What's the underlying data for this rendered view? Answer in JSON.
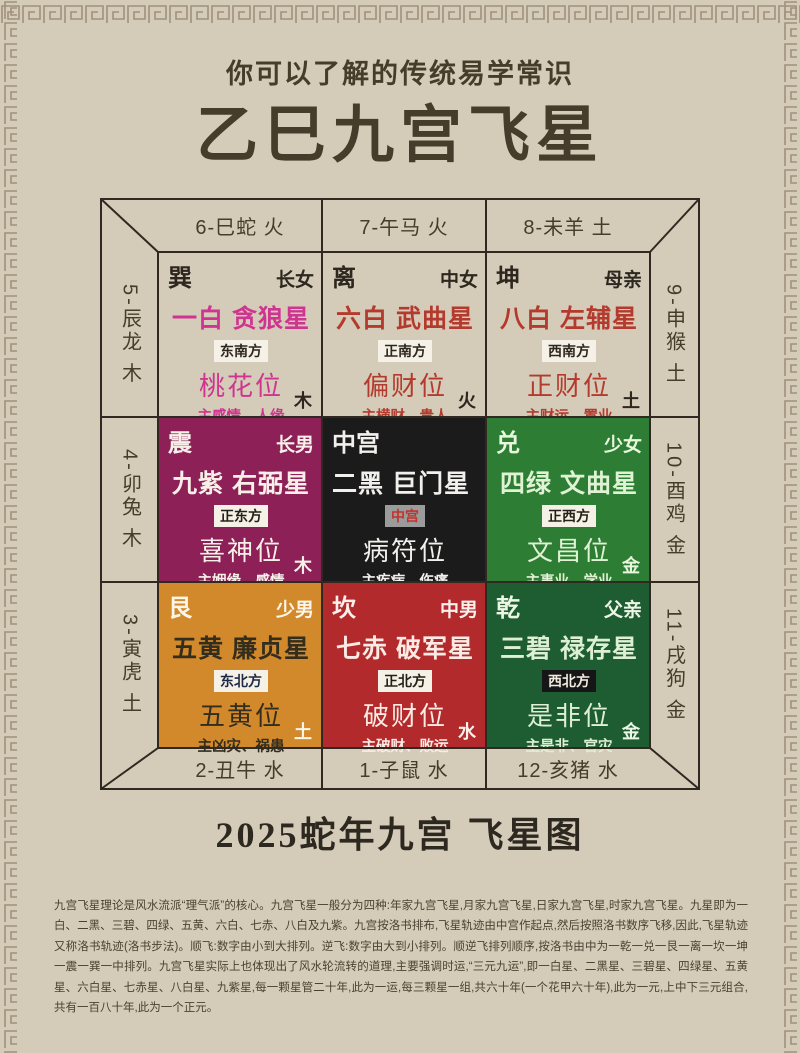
{
  "page": {
    "subtitle": "你可以了解的传统易学常识",
    "title": "乙巳九宫飞星",
    "caption": "2025蛇年九宫 飞星图",
    "footer_text": "九宫飞星理论是风水流派“理气派”的核心。九宫飞星一般分为四种:年家九宫飞星,月家九宫飞星,日家九宫飞星,时家九宫飞星。九星即为一白、二黑、三碧、四绿、五黄、六白、七赤、八白及九紫。九宫按洛书排布,飞星轨迹由中宫作起点,然后按照洛书数序飞移,因此,飞星轨迹又称洛书轨迹(洛书步法)。顺飞:数字由小到大排列。逆飞:数字由大到小排列。顺逆飞排列顺序,按洛书由中为一乾一兑一艮一离一坎一坤一震一巽一中排列。九宫飞星实际上也体现出了风水轮流转的道理,主要强调时运,“三元九运”,即一白星、二黑星、三碧星、四绿星、五黄星、六白星、七赤星、八白星、九紫星,每一颗星管二十年,此为一运,每三颗星一组,共六十年(一个花甲六十年),此为一元,上中下三元组合,共有一百八十年,此为一个正元。",
    "colors": {
      "paper": "#d4cbb8",
      "ink": "#463c2c",
      "border_pattern": "#a0917a"
    }
  },
  "grid": {
    "line_color": "#2f2921",
    "top_labels": [
      "6-巳蛇 火",
      "7-午马 火",
      "8-未羊 土"
    ],
    "bottom_labels": [
      "2-丑牛 水",
      "1-子鼠 水",
      "12-亥猪 水"
    ],
    "left_labels": [
      "5-辰龙 木",
      "4-卯兔 木",
      "3-寅虎 土"
    ],
    "right_labels": [
      "9-申猴 土",
      "10-酉鸡 金",
      "11-戌狗 金"
    ],
    "cells": [
      {
        "trigram": "巽",
        "member": "长女",
        "star": "一白 贪狼星",
        "direction": "东南方",
        "position": "桃花位",
        "description": "主感情、人缘",
        "element": "木",
        "colors": {
          "bg": "transparent",
          "header": "#2d271f",
          "accent": "#cf3590",
          "badge_bg": "#f6f1e6",
          "badge_fg": "#2d271f",
          "element": "#2d271f"
        }
      },
      {
        "trigram": "离",
        "member": "中女",
        "star": "六白 武曲星",
        "direction": "正南方",
        "position": "偏财位",
        "description": "主横财、贵人",
        "element": "火",
        "colors": {
          "bg": "transparent",
          "header": "#2d271f",
          "accent": "#b53a2e",
          "badge_bg": "#f6f1e6",
          "badge_fg": "#2d271f",
          "element": "#2d271f"
        }
      },
      {
        "trigram": "坤",
        "member": "母亲",
        "star": "八白 左辅星",
        "direction": "西南方",
        "position": "正财位",
        "description": "主财运、置业",
        "element": "土",
        "colors": {
          "bg": "transparent",
          "header": "#2d271f",
          "accent": "#b53a2e",
          "badge_bg": "#f6f1e6",
          "badge_fg": "#2d271f",
          "element": "#2d271f"
        }
      },
      {
        "trigram": "震",
        "member": "长男",
        "star": "九紫 右弼星",
        "direction": "正东方",
        "position": "喜神位",
        "description": "主姻缘、感情",
        "element": "木",
        "colors": {
          "bg": "#8c2057",
          "header": "#f8f0e8",
          "accent": "#f8f0e8",
          "badge_bg": "#f6f1e6",
          "badge_fg": "#23201a",
          "element": "#f8f0e8"
        }
      },
      {
        "trigram": "中宫",
        "member": "",
        "star": "二黑 巨门星",
        "direction": "中宫",
        "position": "病符位",
        "description": "主疾病、伤痛",
        "element": "",
        "colors": {
          "bg": "#1b1b1b",
          "header": "#f2f0ec",
          "accent": "#f2f0ec",
          "badge_bg": "#9b9b9b",
          "badge_fg": "#c2332c",
          "element": "#f2f0ec"
        }
      },
      {
        "trigram": "兑",
        "member": "少女",
        "star": "四绿 文曲星",
        "direction": "正西方",
        "position": "文昌位",
        "description": "主事业、学业",
        "element": "金",
        "colors": {
          "bg": "#2e7d35",
          "header": "#e7f6dd",
          "accent": "#dff2d3",
          "badge_bg": "#f6f1e6",
          "badge_fg": "#23201a",
          "element": "#e7f6dd"
        }
      },
      {
        "trigram": "艮",
        "member": "少男",
        "star": "五黄 廉贞星",
        "direction": "东北方",
        "position": "五黄位",
        "description": "主凶灾、祸患",
        "element": "土",
        "colors": {
          "bg": "#d2892b",
          "header": "#fcf5e9",
          "accent": "#332d1d",
          "badge_bg": "#f6f1e6",
          "badge_fg": "#1e2945",
          "element": "#fcf5e9"
        }
      },
      {
        "trigram": "坎",
        "member": "中男",
        "star": "七赤 破军星",
        "direction": "正北方",
        "position": "破财位",
        "description": "主破财、败运",
        "element": "水",
        "colors": {
          "bg": "#b22a2b",
          "header": "#fdf0ec",
          "accent": "#fcebe5",
          "badge_bg": "#f6f1e6",
          "badge_fg": "#23201a",
          "element": "#fdf0ec"
        }
      },
      {
        "trigram": "乾",
        "member": "父亲",
        "star": "三碧 禄存星",
        "direction": "西北方",
        "position": "是非位",
        "description": "主是非、官灾",
        "element": "金",
        "colors": {
          "bg": "#1e5c31",
          "header": "#ecf6e5",
          "accent": "#def0d4",
          "badge_bg": "#161616",
          "badge_fg": "#f2ece0",
          "element": "#ecf6e5"
        }
      }
    ]
  }
}
